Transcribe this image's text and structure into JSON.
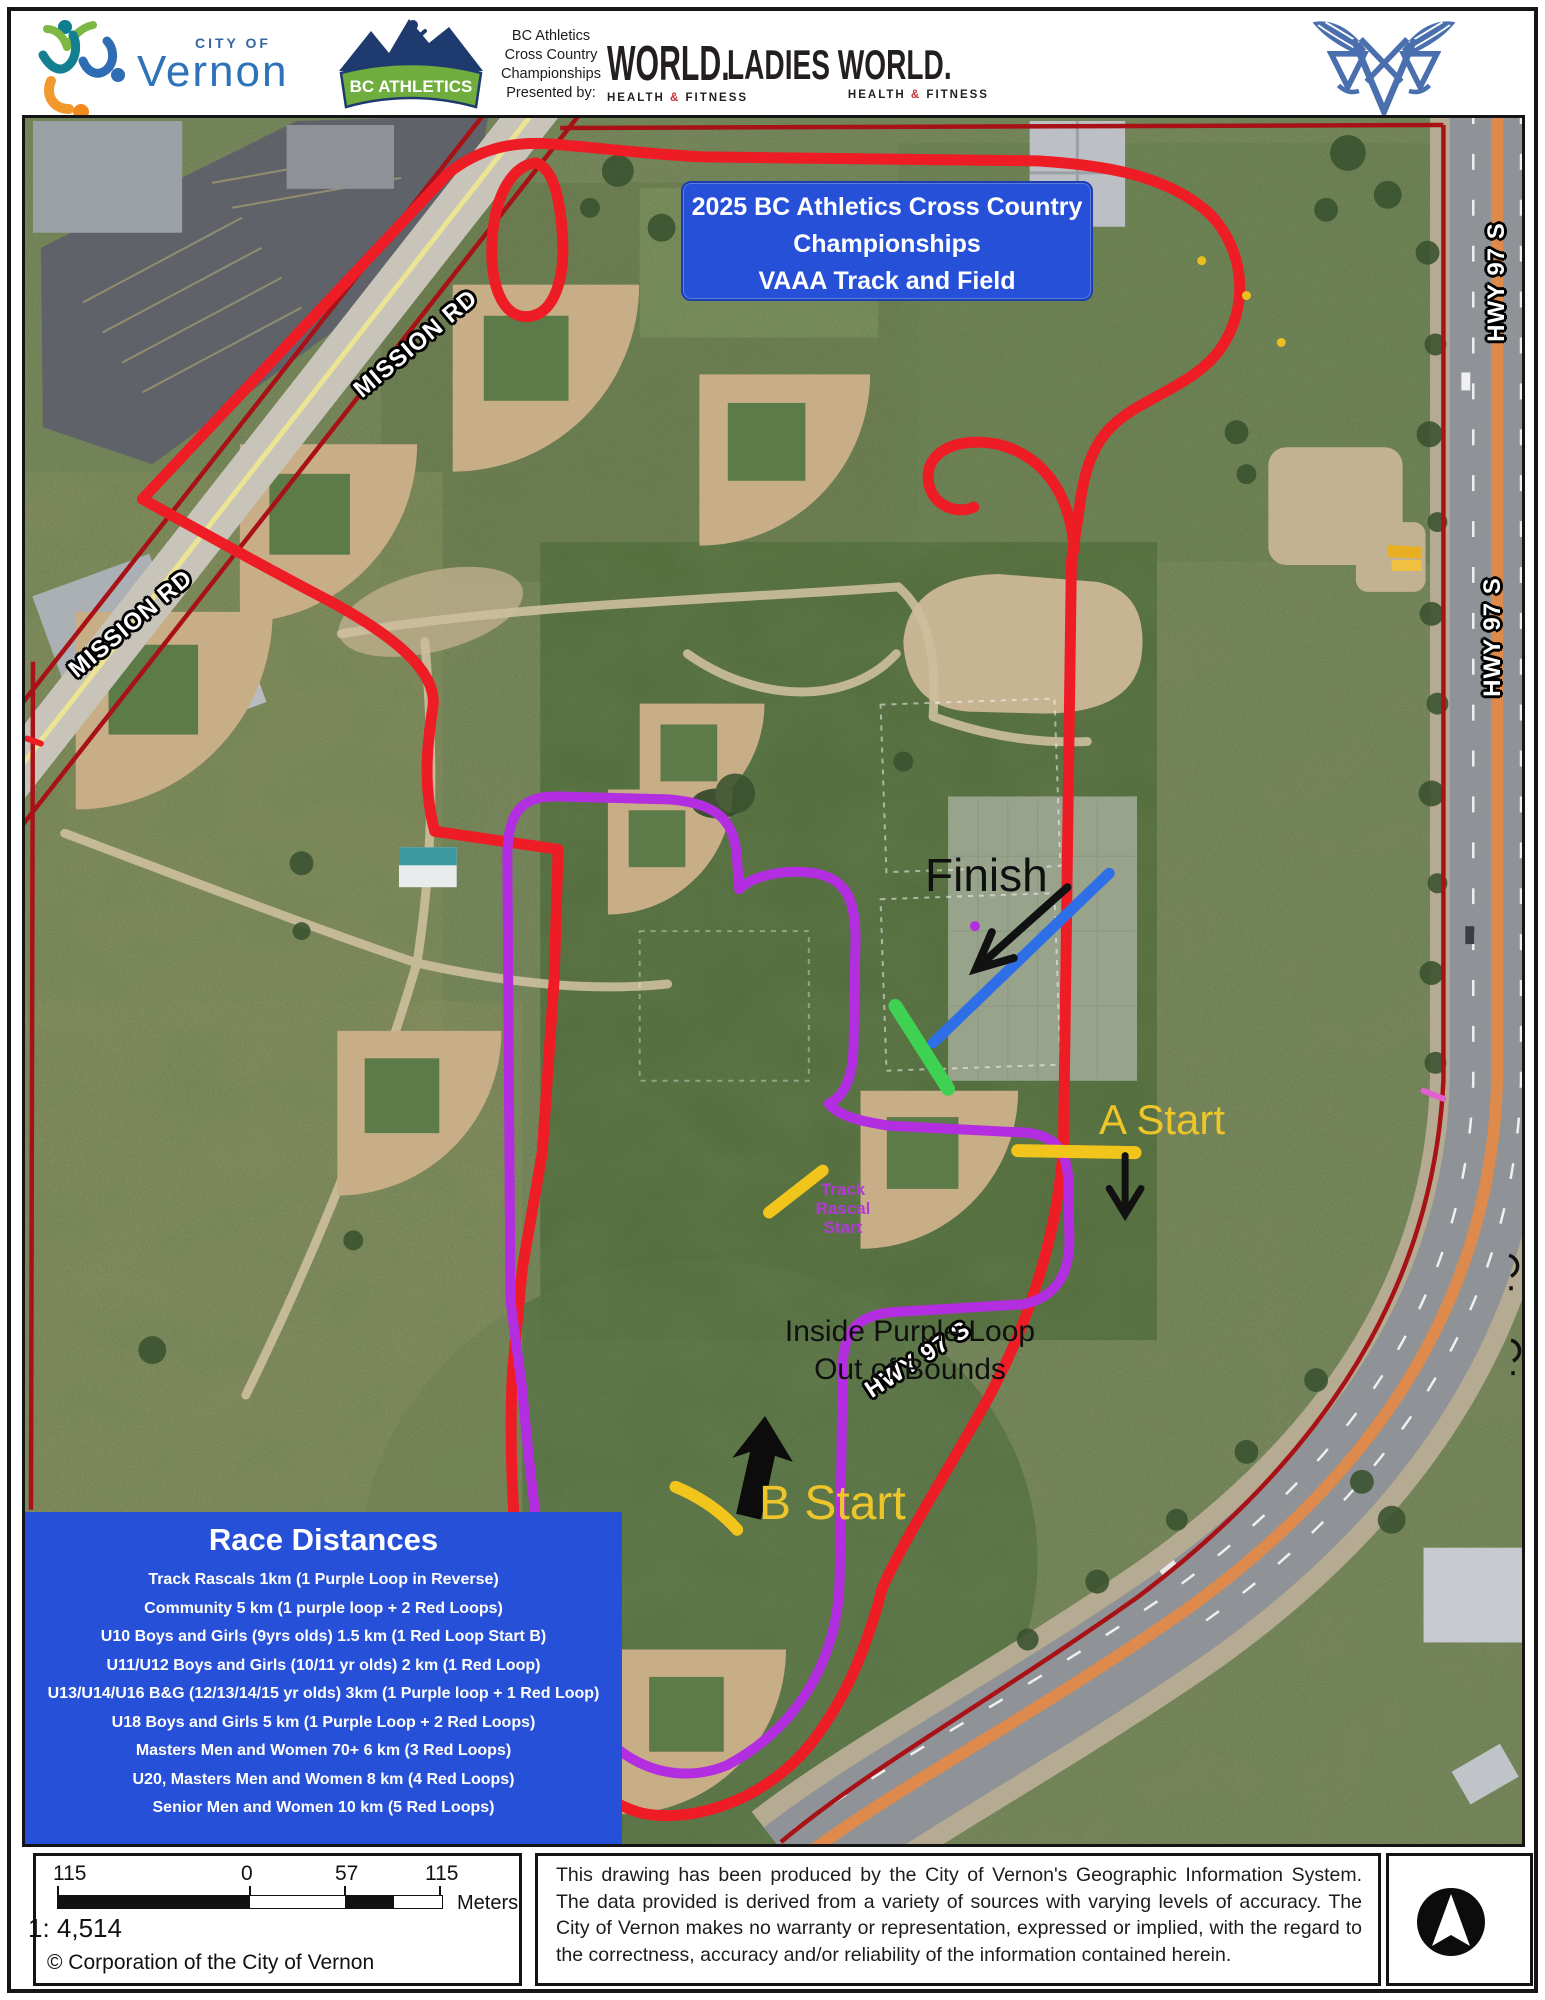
{
  "header": {
    "vernon": {
      "top": "CITY OF",
      "name": "Vernon"
    },
    "bc_athletics": {
      "banner": "BC ATHLETICS"
    },
    "presented_by": [
      "BC Athletics",
      "Cross Country",
      "Championships",
      "Presented by:"
    ],
    "world": {
      "name": "WORLD.",
      "sub_health": "HEALTH",
      "sub_amp": "&",
      "sub_fitness": "FITNESS"
    },
    "ladies_world": {
      "name": "LADIES WORLD.",
      "sub_health": "HEALTH",
      "sub_amp": "&",
      "sub_fitness": "FITNESS"
    }
  },
  "map": {
    "title_box": {
      "line1": "2025 BC Athletics Cross Country",
      "line2": "Championships",
      "line3": "VAAA Track and Field"
    },
    "labels": {
      "finish": "Finish",
      "a_start": "A Start",
      "b_start": "B Start",
      "track_rascal": [
        "Track",
        "Rascal",
        "Start"
      ],
      "oob1": "Inside Purple Loop",
      "oob2": "Out of Bounds",
      "mission_rd": "MISSION RD",
      "hwy": "HWY 97 S"
    },
    "race_box": {
      "title": "Race Distances",
      "races": [
        "Track Rascals 1km (1 Purple Loop in Reverse)",
        "Community 5 km (1 purple loop + 2 Red Loops)",
        "U10 Boys and Girls (9yrs olds) 1.5 km (1 Red Loop Start B)",
        "U11/U12  Boys and Girls (10/11 yr olds) 2 km (1 Red Loop)",
        "U13/U14/U16 B&G (12/13/14/15 yr olds) 3km (1 Purple loop + 1 Red Loop)",
        "U18 Boys and Girls  5 km (1 Purple Loop + 2 Red Loops)",
        "Masters Men and Women 70+ 6 km (3 Red Loops)",
        "U20, Masters Men and Women  8 km (4 Red Loops)",
        "Senior Men and Women 10 km (5 Red Loops)"
      ]
    }
  },
  "footer": {
    "scale": {
      "t0": "115",
      "t1": "0",
      "t2": "57",
      "t3": "115",
      "unit": "Meters",
      "ratio": "1: 4,514",
      "copyright": "© Corporation of the City of Vernon"
    },
    "disclaimer": "This drawing has been produced by the City of Vernon's Geographic Information System. The data provided is derived from a variety of sources with varying levels of accuracy. The City of Vernon makes no warranty or representation, expressed or implied, with the regard to the correctness, accuracy and/or reliability of the information contained herein."
  },
  "colors": {
    "course_red": "#ee1c25",
    "course_purple": "#b32ee0",
    "finish_blue": "#2e6fe8",
    "start_green": "#3ed152",
    "start_yellow": "#f2c51d",
    "box_blue": "#2750d8"
  }
}
